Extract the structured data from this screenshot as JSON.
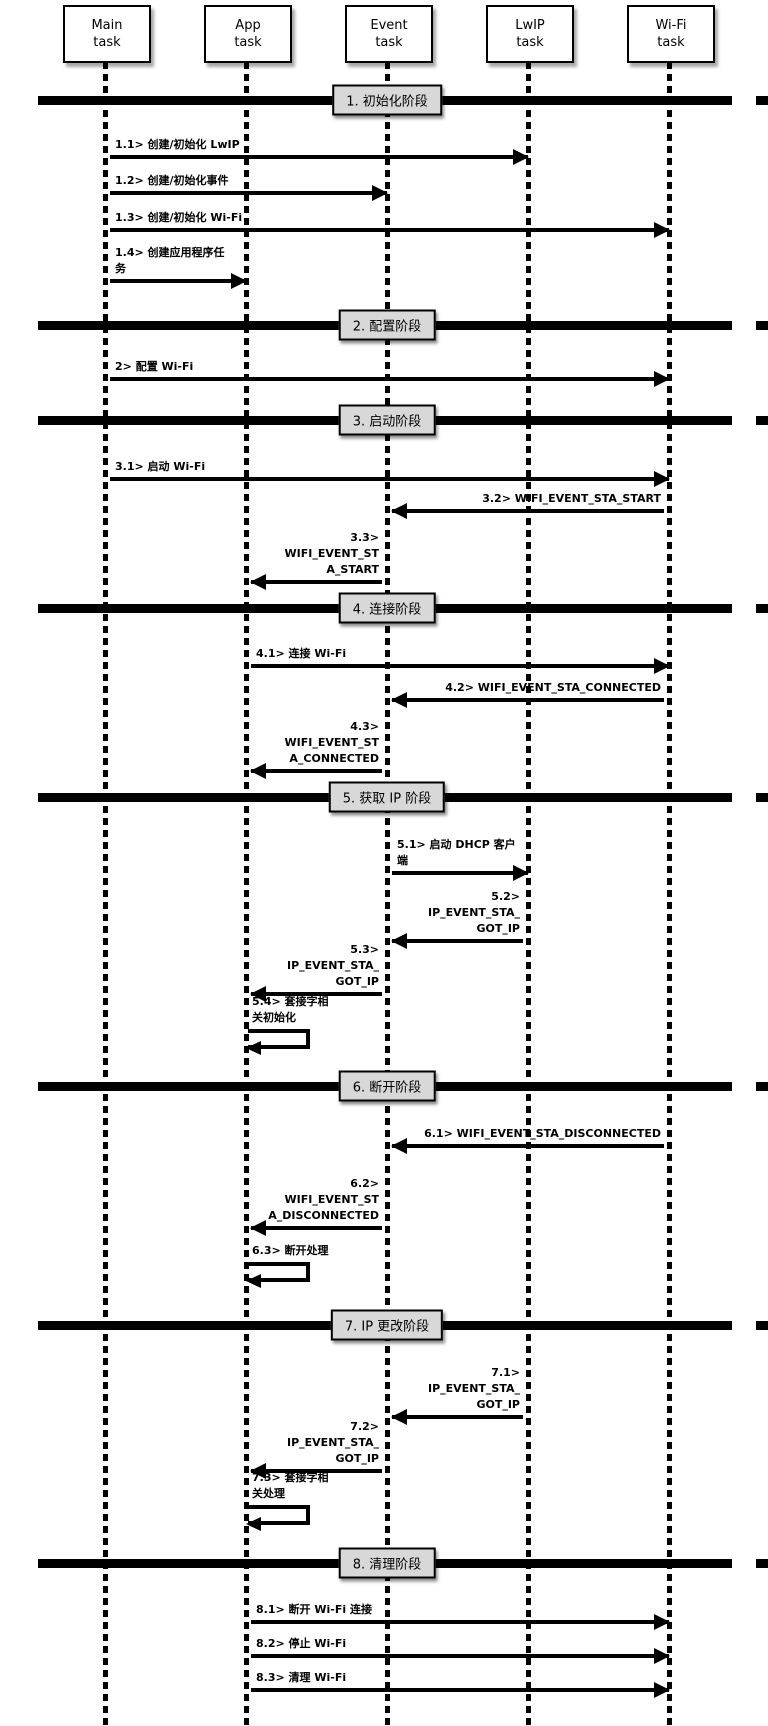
{
  "diagram_type": "sequence-diagram",
  "colors": {
    "line": "#000000",
    "phase_box_bg": "#d8d8d8",
    "background": "#ffffff"
  },
  "actors": [
    {
      "name": "Main\ntask"
    },
    {
      "name": "App\ntask"
    },
    {
      "name": "Event\ntask"
    },
    {
      "name": "LwIP\ntask"
    },
    {
      "name": "Wi-Fi\ntask"
    }
  ],
  "phases": [
    {
      "label": "1. 初始化阶段"
    },
    {
      "label": "2. 配置阶段"
    },
    {
      "label": "3. 启动阶段"
    },
    {
      "label": "4. 连接阶段"
    },
    {
      "label": "5. 获取 IP 阶段"
    },
    {
      "label": "6. 断开阶段"
    },
    {
      "label": "7. IP 更改阶段"
    },
    {
      "label": "8. 清理阶段"
    }
  ],
  "messages": [
    {
      "id": "1.1",
      "label": "1.1> 创建/初始化 LwIP",
      "from": "Main task",
      "to": "LwIP task"
    },
    {
      "id": "1.2",
      "label": "1.2> 创建/初始化事件",
      "from": "Main task",
      "to": "Event task"
    },
    {
      "id": "1.3",
      "label": "1.3> 创建/初始化 Wi-Fi",
      "from": "Main task",
      "to": "Wi-Fi task"
    },
    {
      "id": "1.4",
      "label": "1.4> 创建应用程序任\n务",
      "from": "Main task",
      "to": "App task"
    },
    {
      "id": "2",
      "label": "2> 配置 Wi-Fi",
      "from": "Main task",
      "to": "Wi-Fi task"
    },
    {
      "id": "3.1",
      "label": "3.1> 启动 Wi-Fi",
      "from": "Main task",
      "to": "Wi-Fi task"
    },
    {
      "id": "3.2",
      "label": "3.2> WIFI_EVENT_STA_START",
      "from": "Wi-Fi task",
      "to": "Event task"
    },
    {
      "id": "3.3",
      "label": "3.3> WIFI_EVENT_ST\nA_START",
      "from": "Event task",
      "to": "App task"
    },
    {
      "id": "4.1",
      "label": "4.1> 连接 Wi-Fi",
      "from": "App task",
      "to": "Wi-Fi task"
    },
    {
      "id": "4.2",
      "label": "4.2> WIFI_EVENT_STA_CONNECTED",
      "from": "Wi-Fi task",
      "to": "Event task"
    },
    {
      "id": "4.3",
      "label": "4.3> WIFI_EVENT_ST\nA_CONNECTED",
      "from": "Event task",
      "to": "App task"
    },
    {
      "id": "5.1",
      "label": "5.1> 启动 DHCP 客户\n端",
      "from": "Event task",
      "to": "LwIP task"
    },
    {
      "id": "5.2",
      "label": "5.2> IP_EVENT_STA_\nGOT_IP",
      "from": "LwIP task",
      "to": "Event task"
    },
    {
      "id": "5.3",
      "label": "5.3> IP_EVENT_STA_\nGOT_IP",
      "from": "Event task",
      "to": "App task"
    },
    {
      "id": "5.4",
      "label": "5.4> 套接字相\n关初始化",
      "from": "App task",
      "to": "App task"
    },
    {
      "id": "6.1",
      "label": "6.1> WIFI_EVENT_STA_DISCONNECTED",
      "from": "Wi-Fi task",
      "to": "Event task"
    },
    {
      "id": "6.2",
      "label": "6.2> WIFI_EVENT_ST\nA_DISCONNECTED",
      "from": "Event task",
      "to": "App task"
    },
    {
      "id": "6.3",
      "label": "6.3> 断开处理",
      "from": "App task",
      "to": "App task"
    },
    {
      "id": "7.1",
      "label": "7.1> IP_EVENT_STA_\nGOT_IP",
      "from": "LwIP task",
      "to": "Event task"
    },
    {
      "id": "7.2",
      "label": "7.2> IP_EVENT_STA_\nGOT_IP",
      "from": "Event task",
      "to": "App task"
    },
    {
      "id": "7.3",
      "label": "7.3> 套接字相\n关处理",
      "from": "App task",
      "to": "App task"
    },
    {
      "id": "8.1",
      "label": "8.1> 断开 Wi-Fi 连接",
      "from": "App task",
      "to": "Wi-Fi task"
    },
    {
      "id": "8.2",
      "label": "8.2> 停止 Wi-Fi",
      "from": "App task",
      "to": "Wi-Fi task"
    },
    {
      "id": "8.3",
      "label": "8.3> 清理 Wi-Fi",
      "from": "App task",
      "to": "Wi-Fi task"
    }
  ]
}
